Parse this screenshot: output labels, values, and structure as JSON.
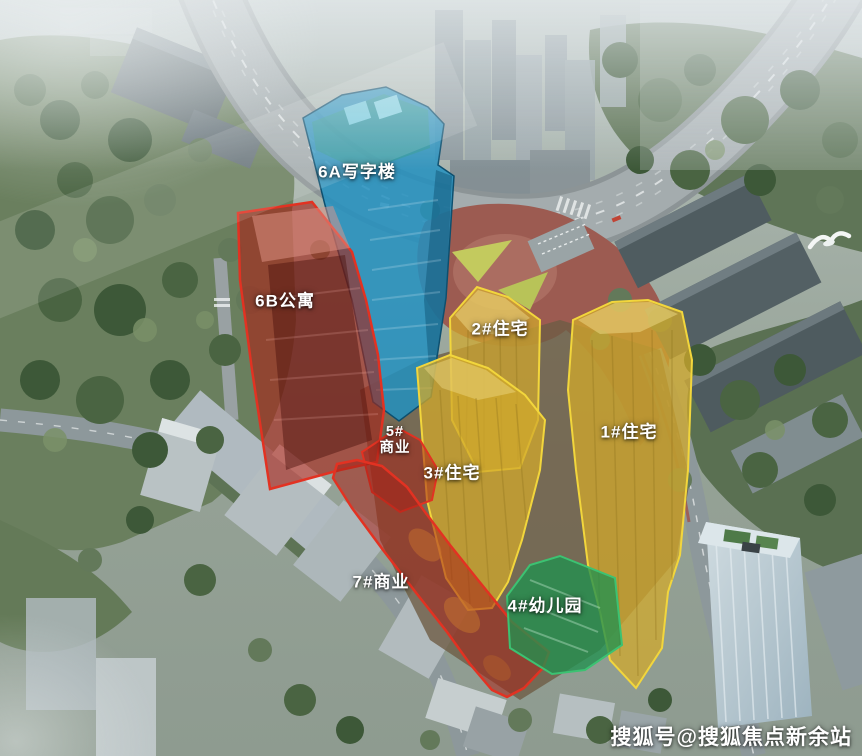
{
  "site_plan": {
    "title": "aerial-development-site-plan",
    "buildings": [
      {
        "id": "6A",
        "label": "6A写字楼",
        "use": "office",
        "overlay": "#2391c0",
        "border": "#0d4f6e"
      },
      {
        "id": "6B",
        "label": "6B公寓",
        "use": "apartment",
        "overlay": "#a82318",
        "border": "#e23222"
      },
      {
        "id": "2#",
        "label": "2#住宅",
        "use": "residential",
        "overlay": "#d2a92c",
        "border": "#f2d63c"
      },
      {
        "id": "1#",
        "label": "1#住宅",
        "use": "residential",
        "overlay": "#d2a92c",
        "border": "#f2d63c"
      },
      {
        "id": "5#",
        "label": "5#\n商业",
        "use": "commercial",
        "overlay": "#a82318",
        "border": "#e23222"
      },
      {
        "id": "3#",
        "label": "3#住宅",
        "use": "residential",
        "overlay": "#d2a92c",
        "border": "#f2d63c"
      },
      {
        "id": "7#",
        "label": "7#商业",
        "use": "commercial",
        "overlay": "#a82318",
        "border": "#e23222"
      },
      {
        "id": "4#",
        "label": "4#幼儿园",
        "use": "kindergarten",
        "overlay": "#219150",
        "border": "#3cc272"
      }
    ],
    "watermark": "搜狐号@搜狐焦点新余站",
    "label_text_color": "#ffffff"
  }
}
